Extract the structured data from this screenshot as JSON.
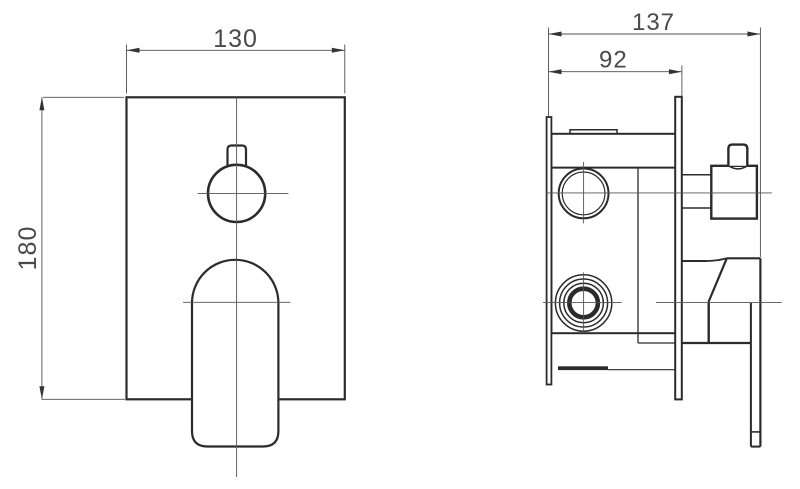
{
  "drawing": {
    "type": "technical-dimension-drawing",
    "background": "#ffffff",
    "outline_color": "#2b2b2b",
    "centerline_color": "#555555",
    "dimension_color": "#4a4a4a",
    "views": {
      "front": {
        "width_dim": "130",
        "height_dim": "180"
      },
      "side": {
        "total_depth_dim": "137",
        "recess_depth_dim": "92"
      }
    }
  }
}
